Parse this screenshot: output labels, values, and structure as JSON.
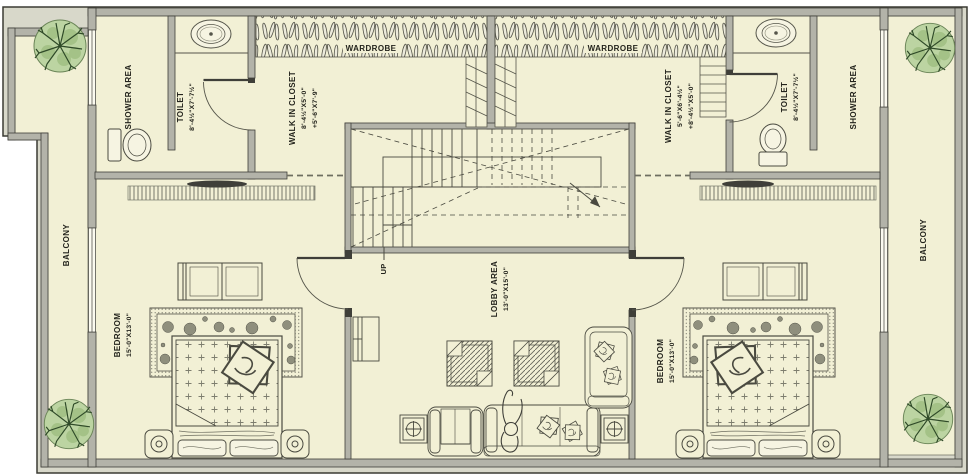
{
  "meta": {
    "type": "floor-plan",
    "floor": "bedroom level"
  },
  "colors": {
    "floor": "#f2f0d5",
    "wall": "#b3b3a9",
    "wall_outline": "#3f3f39",
    "frame_band": "#d8d8ca",
    "line": "#4a4a40",
    "tree_fill": "#bcd4a2",
    "tree_dark": "#2f4a28"
  },
  "rooms": {
    "shower_left": {
      "label": "SHOWER AREA"
    },
    "toilet_left": {
      "label": "TOILET",
      "dims": "8'-4½\"X7'-7½\""
    },
    "closet_left": {
      "label": "WALK IN CLOSET",
      "dims": "8'-4½\"X5'-0\"",
      "dims2": "+5'-6\"X7'-9\""
    },
    "wardrobe_left": {
      "label": "WARDROBE"
    },
    "wardrobe_right": {
      "label": "WARDROBE"
    },
    "closet_right": {
      "label": "WALK IN CLOSET",
      "dims": "5'-6\"X6'-4½\"",
      "dims2": "+8'-4½\"X5'-0\""
    },
    "toilet_right": {
      "label": "TOILET",
      "dims": "8'-4½\"X7'-7½\""
    },
    "shower_right": {
      "label": "SHOWER AREA"
    },
    "balcony_left": {
      "label": "BALCONY"
    },
    "balcony_right": {
      "label": "BALCONY"
    },
    "bedroom_left": {
      "label": "BEDROOM",
      "dims": "15'-0\"X13'-0\""
    },
    "bedroom_right": {
      "label": "BEDROOM",
      "dims": "15'-0\"X13'-0\""
    },
    "lobby": {
      "label": "LOBBY AREA",
      "dims": "13'-0\"X15'-0\""
    },
    "stairs": {
      "label": "UP"
    }
  }
}
